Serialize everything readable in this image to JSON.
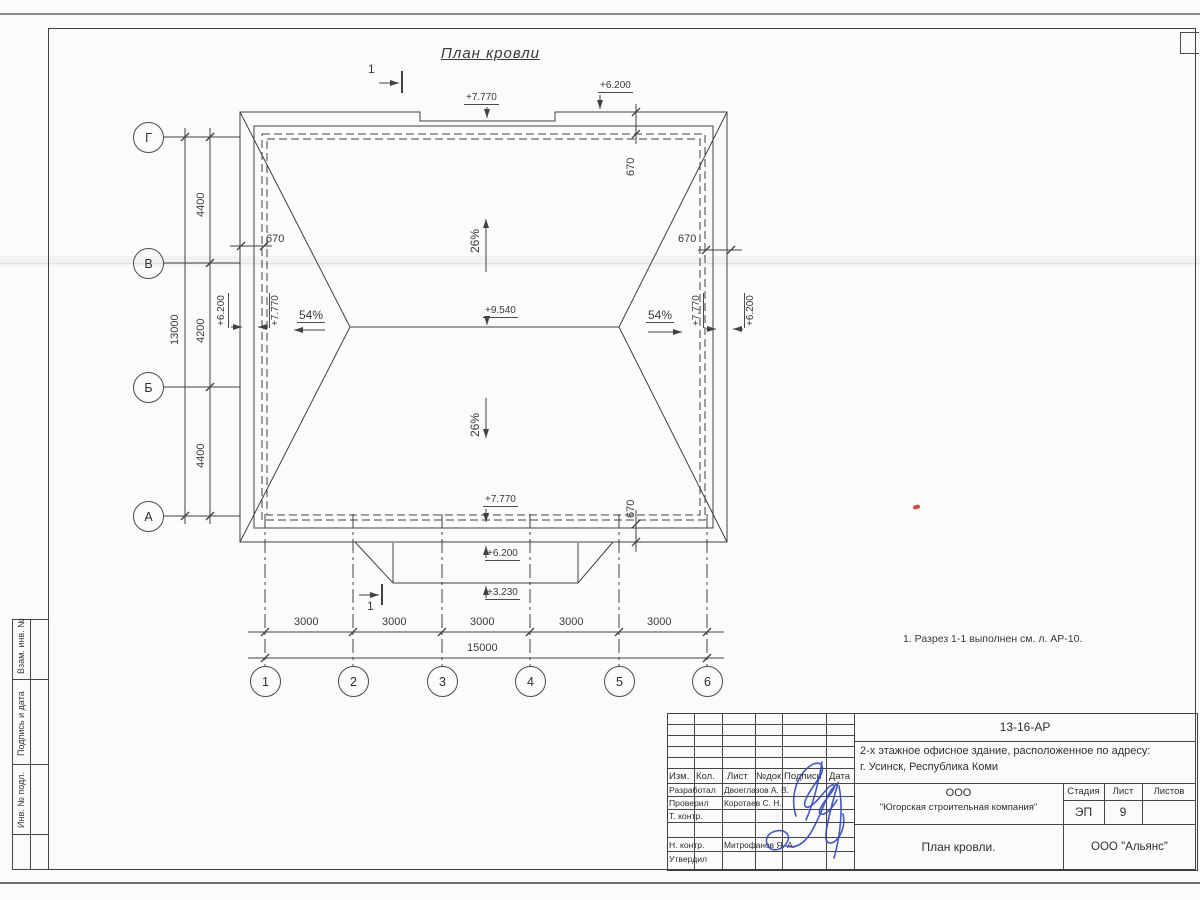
{
  "sheet": {
    "title": "План кровли",
    "note": "1. Разрез 1-1 выполнен см. л. АР-10."
  },
  "plan": {
    "elev_7770": "+7.770",
    "elev_6200": "+6.200",
    "elev_9540": "+9.540",
    "elev_3230": "+3.230",
    "slope_26": "26%",
    "slope_54": "54%",
    "overhang_670": "670",
    "section_num": "1"
  },
  "dims": {
    "d4400": "4400",
    "d4200": "4200",
    "d13000": "13000",
    "d3000": "3000",
    "d15000": "15000"
  },
  "axes": {
    "left": [
      "Г",
      "В",
      "Б",
      "А"
    ],
    "bottom": [
      "1",
      "2",
      "3",
      "4",
      "5",
      "6"
    ]
  },
  "sidebar": {
    "vzam": "Взам. инв. №",
    "podpis_data": "Подпись и дата",
    "inv_podl": "Инв. № подл."
  },
  "titleblock": {
    "doc_number": "13-16-АР",
    "project_line1": "2-х этажное офисное здание, расположенное по адресу:",
    "project_line2": "г. Усинск, Республика Коми",
    "col_izm": "Изм.",
    "col_kol": "Кол.",
    "col_list": "Лист",
    "col_ndok": "№док.",
    "col_podpis": "Подпись",
    "col_data": "Дата",
    "row_developed": "Разработал",
    "name_developed": "Двоеглазов А. В.",
    "row_checked": "Проверил",
    "name_checked": "Коротаев С. Н.",
    "row_tcontrol": "Т. контр.",
    "row_ncontrol": "Н. контр.",
    "name_ncontrol": "Митрофанов Я. А.",
    "row_approved": "Утвердил",
    "company_line1": "ООО",
    "company_line2": "\"Югорская строительная компания\"",
    "stage_label": "Стадия",
    "sheet_label": "Лист",
    "sheets_label": "Листов",
    "stage_value": "ЭП",
    "sheet_value": "9",
    "drawing_title": "План кровли.",
    "contractor": "ООО \"Альянс\""
  }
}
